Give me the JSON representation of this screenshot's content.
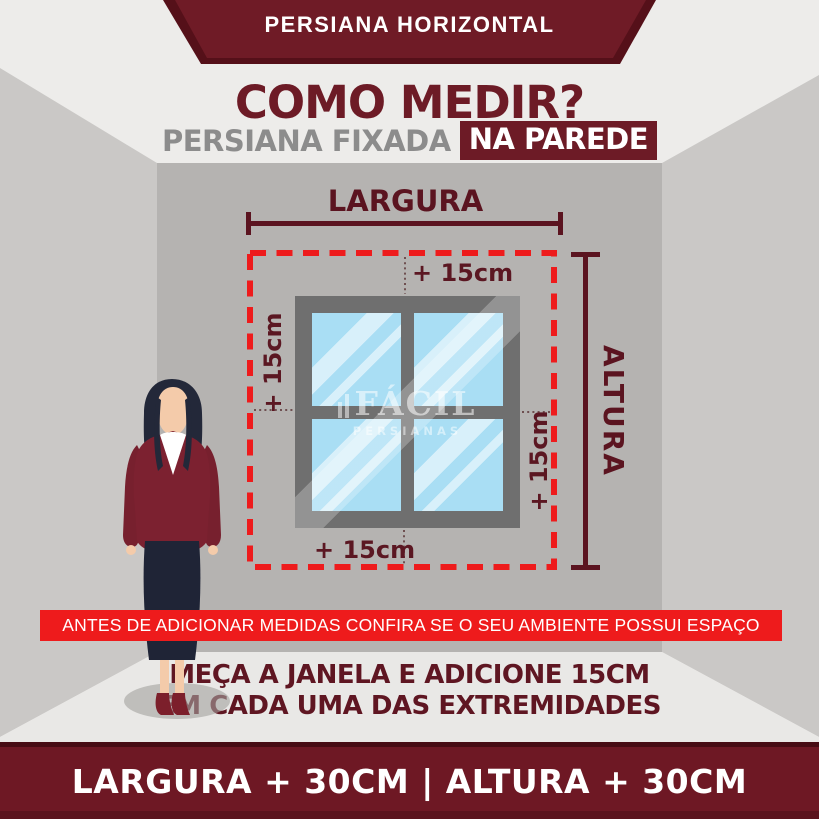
{
  "header": {
    "banner": "PERSIANA HORIZONTAL",
    "title": "COMO MEDIR?",
    "subtitle": "PERSIANA FIXADA",
    "subtitle_highlight": "NA PAREDE"
  },
  "diagram": {
    "width_label": "LARGURA",
    "height_label": "ALTURA",
    "offset_top": "+ 15cm",
    "offset_left": "+ 15cm",
    "offset_right": "+ 15cm",
    "offset_bottom": "+ 15cm",
    "watermark": {
      "brand": "FÁCIL",
      "sub": "PERSIANAS"
    }
  },
  "notice": {
    "warning": "ANTES DE ADICIONAR MEDIDAS CONFIRA SE O SEU AMBIENTE POSSUI ESPAÇO",
    "instruction_line1": "MEÇA A JANELA E ADICIONE 15CM",
    "instruction_line2": "EM CADA UMA DAS EXTREMIDADES"
  },
  "footer": {
    "formula": "LARGURA + 30CM | ALTURA + 30CM"
  },
  "colors": {
    "maroon": "#6d1b26",
    "maroon_dark": "#470c14",
    "measure_line": "#5b1420",
    "alert_red": "#ee1b1c",
    "back_wall": "#b5b3b1",
    "side_wall": "#cac8c6",
    "floor": "#e9e8e6",
    "glass_blue": "#a9def4",
    "window_frame": "#6f6f6f"
  }
}
